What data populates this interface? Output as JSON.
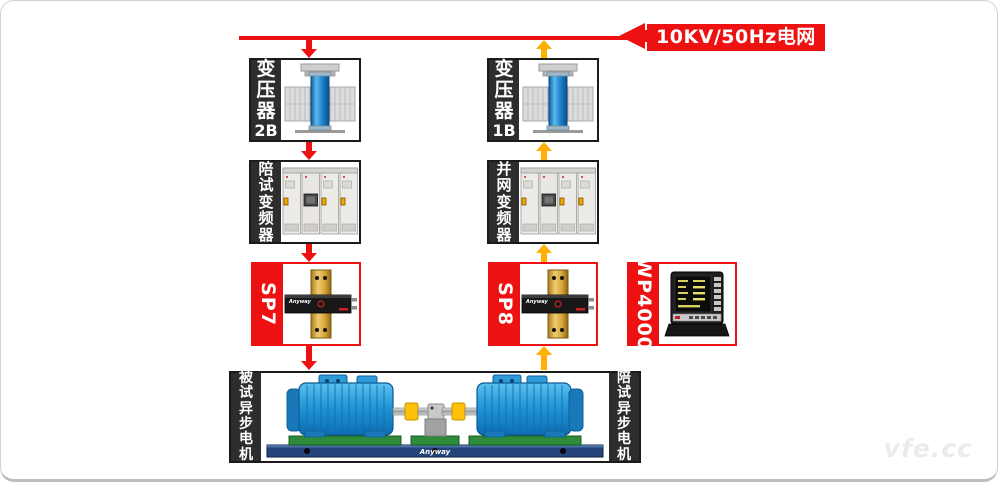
{
  "watermark": "vfe.cc",
  "grid": {
    "label": "10KV/50Hz电网"
  },
  "colors": {
    "flow_down": "#ee1111",
    "flow_up": "#ffb000",
    "box_border": "#1a1a1a",
    "sidebar_dark": "#2d2d2d",
    "accent_red": "#ee1111",
    "motor_blue": "#2196d6",
    "coupling_yellow": "#ffc107"
  },
  "boxes": {
    "transformer_2b": {
      "cn": "变压器",
      "id": "2B"
    },
    "transformer_1b": {
      "cn": "变压器",
      "id": "1B"
    },
    "inverter_test": {
      "label": "陪试变频器"
    },
    "inverter_grid": {
      "label": "并网变频器"
    },
    "sp7": {
      "label": "SP7",
      "brand": "Anyway"
    },
    "sp8": {
      "label": "SP8",
      "brand": "Anyway"
    },
    "wp4000": {
      "label": "WP4000"
    },
    "motors": {
      "left": "被试异步电机",
      "right": "陪试异步电机",
      "brand": "Anyway"
    }
  }
}
